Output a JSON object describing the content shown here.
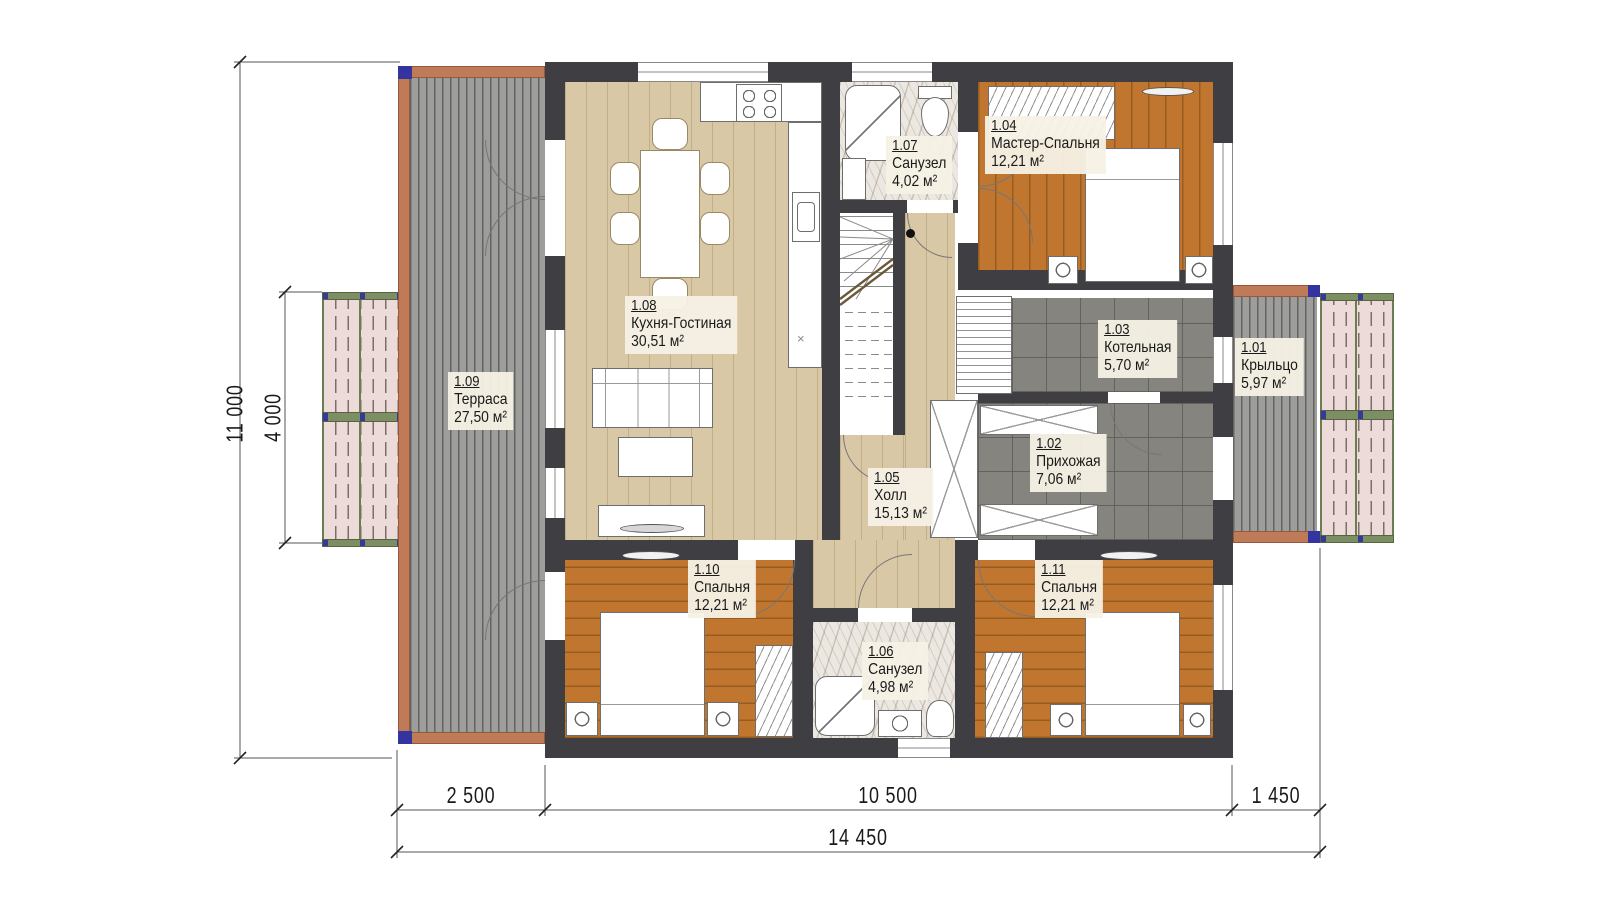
{
  "plan": {
    "rooms": [
      {
        "id": "1.01",
        "name": "Крыльцо",
        "area": "5,97 м²"
      },
      {
        "id": "1.02",
        "name": "Прихожая",
        "area": "7,06 м²"
      },
      {
        "id": "1.03",
        "name": "Котельная",
        "area": "5,70 м²"
      },
      {
        "id": "1.04",
        "name": "Мастер-Спальня",
        "area": "12,21 м²"
      },
      {
        "id": "1.05",
        "name": "Холл",
        "area": "15,13 м²"
      },
      {
        "id": "1.06",
        "name": "Санузел",
        "area": "4,98 м²"
      },
      {
        "id": "1.07",
        "name": "Санузел",
        "area": "4,02 м²"
      },
      {
        "id": "1.08",
        "name": "Кухня-Гостиная",
        "area": "30,51 м²"
      },
      {
        "id": "1.09",
        "name": "Терраса",
        "area": "27,50 м²"
      },
      {
        "id": "1.10",
        "name": "Спальня",
        "area": "12,21 м²"
      },
      {
        "id": "1.11",
        "name": "Спальня",
        "area": "12,21 м²"
      }
    ],
    "dimensions": {
      "bottom_segments": [
        "2 500",
        "10 500",
        "1 450"
      ],
      "bottom_total": "14 450",
      "left_outer": "11 000",
      "left_inner": "4 000"
    },
    "marks": {
      "island_x": "×"
    },
    "colors": {
      "wall": "#3f3e43",
      "wood_light": "#d9c8a5",
      "wood_orange": "#c1762f",
      "tile_dark": "#85847e",
      "deck_gray": "#9d9d9b",
      "terracotta": "#bf7a58",
      "pergola_pink": "#ecdbd9",
      "pergola_green": "#6c7d52",
      "accent_blue": "#3434a0"
    }
  }
}
